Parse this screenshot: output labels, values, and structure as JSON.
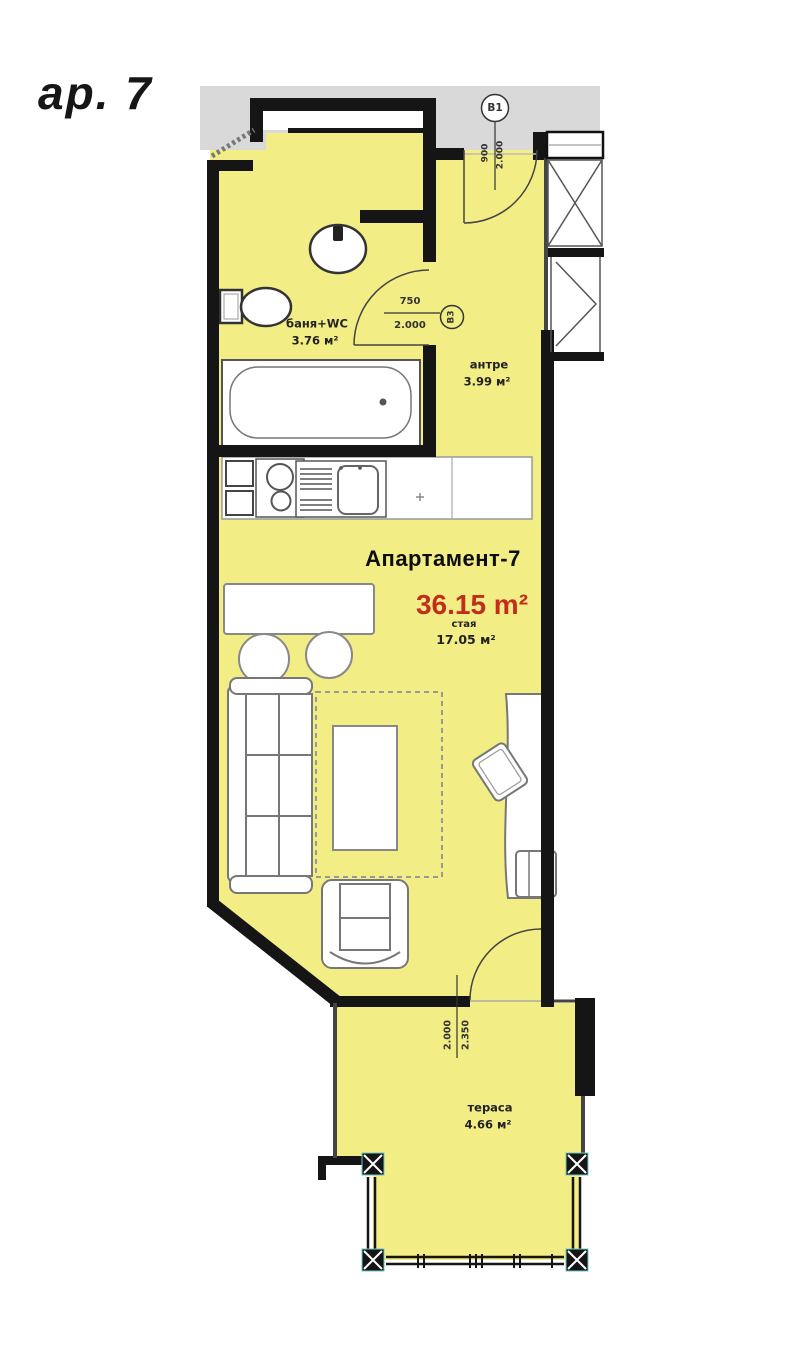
{
  "page": {
    "label": "ар. 7"
  },
  "apartment": {
    "title": "Апартамент-7",
    "total_area": "36.15 m²",
    "room_label": "стая",
    "room_area": "17.05 м²"
  },
  "rooms": {
    "bathroom": {
      "name": "баня+WC",
      "area": "3.76 м²"
    },
    "hall": {
      "name": "антре",
      "area": "3.99 м²"
    },
    "terrace": {
      "name": "тераса",
      "area": "4.66 м²"
    }
  },
  "markers": {
    "entrance": "B1",
    "bath_door": "B3"
  },
  "dimensions": {
    "entrance": {
      "width": "900",
      "height": "2.000"
    },
    "bath_door": {
      "width": "750",
      "height": "2.000"
    },
    "terrace_door": {
      "width": "2.000",
      "height": "2.350"
    }
  },
  "colors": {
    "floor_yellow": "#f2ed85",
    "accent_red": "#c22d1e",
    "band_gray": "#d9d9d9",
    "wall_black": "#151515"
  }
}
